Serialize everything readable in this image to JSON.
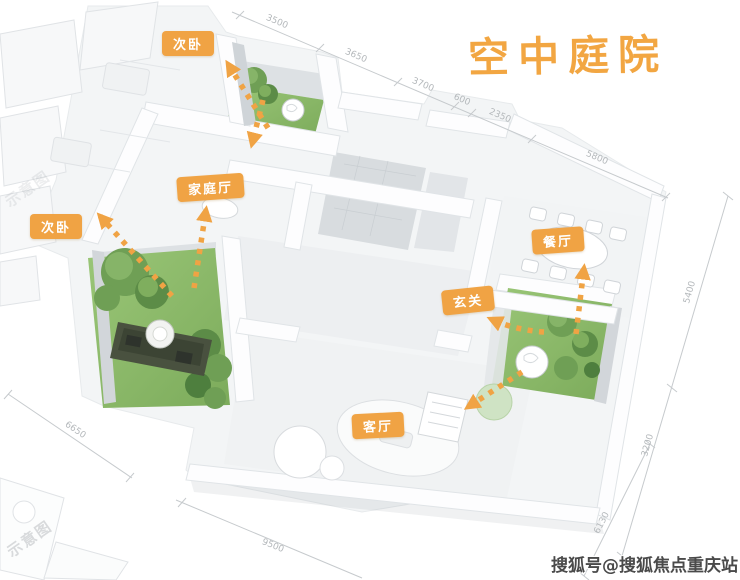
{
  "title": {
    "text": "空中庭院",
    "color": "#F2A642"
  },
  "rooms": {
    "bedroom_top": "次卧",
    "family_hall": "家庭厅",
    "bedroom_left": "次卧",
    "dining": "餐厅",
    "foyer": "玄关",
    "living": "客厅"
  },
  "dimensions": {
    "top": [
      "3500",
      "3650",
      "3700",
      "600",
      "2350",
      "5800"
    ],
    "right": [
      "5400",
      "3200"
    ],
    "bottom": [
      "9500"
    ],
    "bottom_right": [
      "6130"
    ],
    "left": [
      "6650"
    ]
  },
  "arrows": [
    {
      "from": "top-garden",
      "to": "bedroom_top"
    },
    {
      "from": "top-garden",
      "to": "family_hall"
    },
    {
      "from": "left-garden",
      "to": "bedroom_left"
    },
    {
      "from": "left-garden",
      "to": "family_hall"
    },
    {
      "from": "right-garden",
      "to": "dining"
    },
    {
      "from": "right-garden",
      "to": "foyer"
    },
    {
      "from": "right-garden",
      "to": "living"
    }
  ],
  "watermarks": {
    "bottom_right": "搜狐号@搜狐焦点重庆站",
    "corner": "示意图"
  },
  "colors": {
    "accent": "#F0A344",
    "grass": "#8FBD6D",
    "deck": "#49513F",
    "wall": "#FDFDFE"
  }
}
